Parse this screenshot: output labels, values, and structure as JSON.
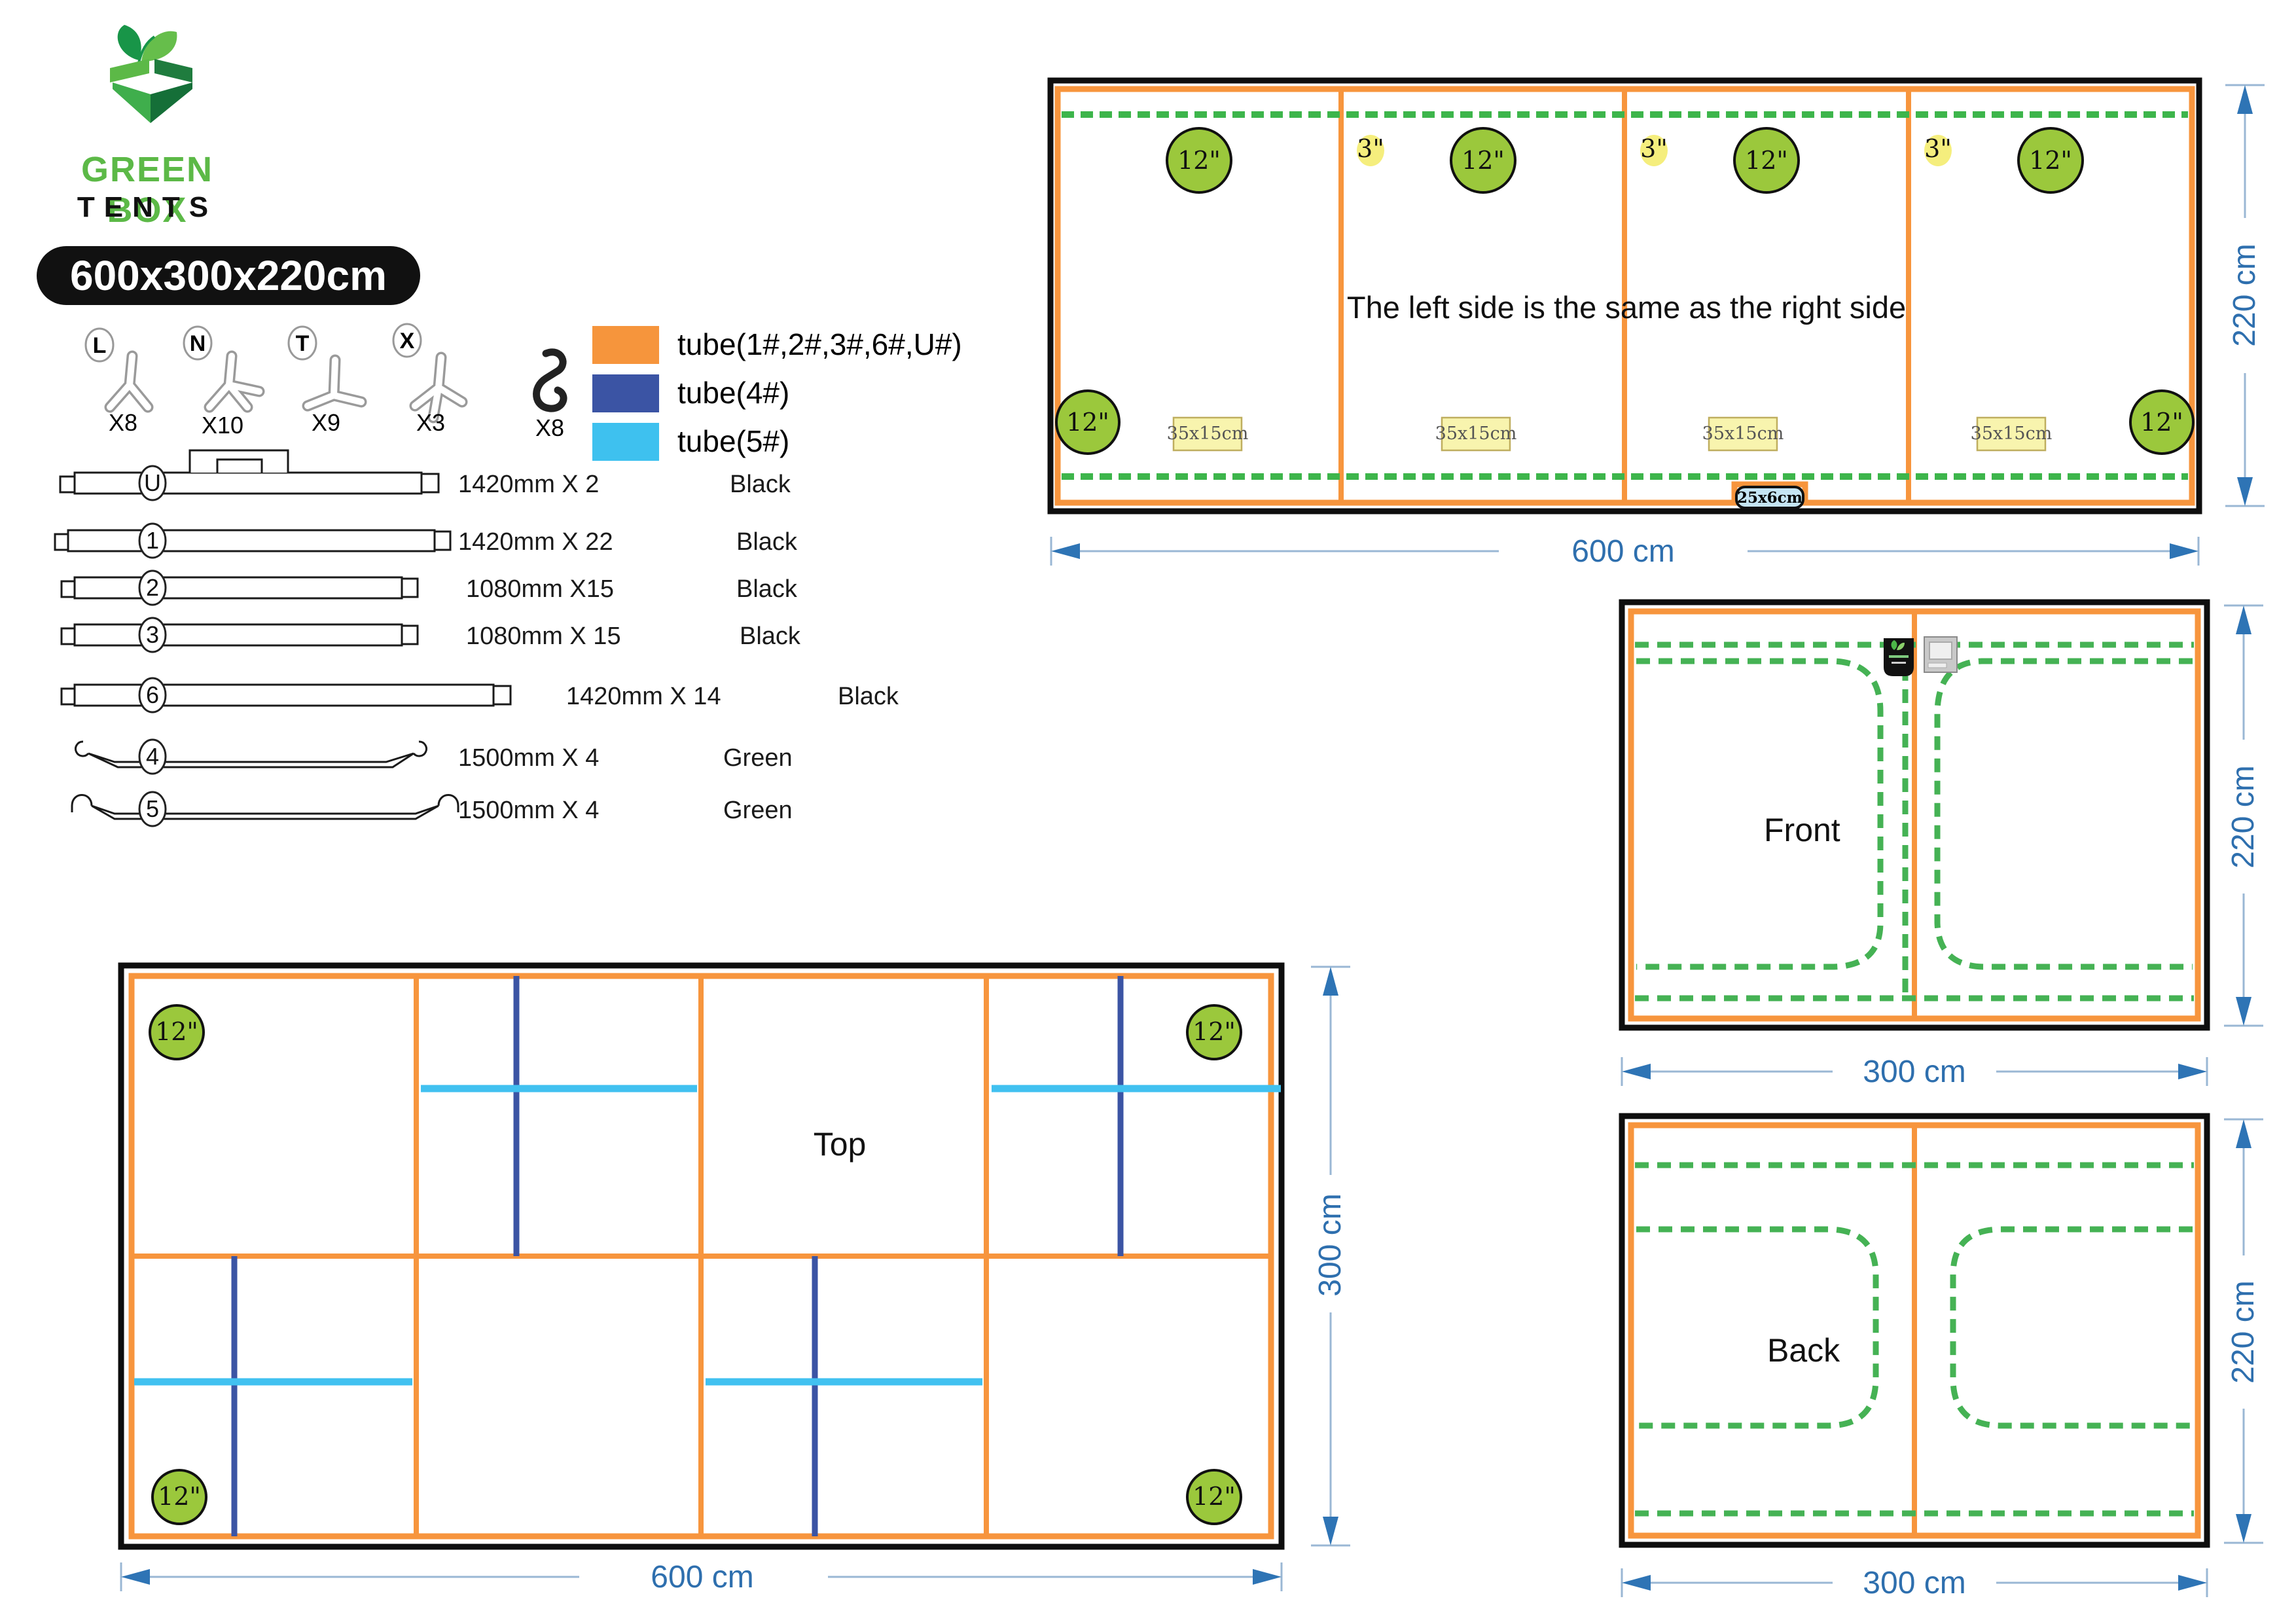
{
  "header": {
    "brand_top": "GREEN BOX",
    "brand_bottom": "TENTS",
    "size_badge": "600x300x220cm"
  },
  "connectors": [
    {
      "id": "L",
      "count": "X8"
    },
    {
      "id": "N",
      "count": "X10"
    },
    {
      "id": "T",
      "count": "X9"
    },
    {
      "id": "X",
      "count": "X3"
    },
    {
      "id": "hook",
      "count": "X8"
    }
  ],
  "legend": [
    {
      "swatch": "#F6953C",
      "label": "tube(1#,2#,3#,6#,U#)"
    },
    {
      "swatch": "#3B54A4",
      "label": "tube(4#)"
    },
    {
      "swatch": "#3EC1EF",
      "label": "tube(5#)"
    }
  ],
  "poles": [
    {
      "id": "U",
      "spec": "1420mm X 2",
      "color": "Black"
    },
    {
      "id": "1",
      "spec": "1420mm X 22",
      "color": "Black"
    },
    {
      "id": "2",
      "spec": "1080mm X15",
      "color": "Black"
    },
    {
      "id": "3",
      "spec": "1080mm X 15",
      "color": "Black"
    },
    {
      "id": "6",
      "spec": "1420mm X 14",
      "color": "Black"
    },
    {
      "id": "4",
      "spec": "1500mm X 4",
      "color": "Green"
    },
    {
      "id": "5",
      "spec": "1500mm X 4",
      "color": "Green"
    }
  ],
  "panels": {
    "side": {
      "note": "The left side is the same as the right side",
      "vent_large": "12\"",
      "vent_small": "3\"",
      "pocket_label": "35x15cm",
      "outlet_label": "25x6cm",
      "width_label": "600 cm",
      "height_label": "220 cm"
    },
    "front": {
      "label": "Front",
      "width_label": "300 cm",
      "height_label": "220 cm"
    },
    "back": {
      "label": "Back",
      "width_label": "300 cm",
      "height_label": "220 cm"
    },
    "top": {
      "label": "Top",
      "vent": "12\"",
      "width_label": "600 cm",
      "height_label": "300 cm"
    }
  },
  "colors": {
    "tube_orange": "#F6953C",
    "tube_blue": "#3B54A4",
    "tube_cyan": "#3EC1EF",
    "dash_green": "#3DB54B",
    "vent_green": "#9BC83C",
    "label_yellow": "#F8F4AE",
    "outlet_blue": "#C5E5F4",
    "dimension_blue": "#2E74B5",
    "brand_green": "#5CB947",
    "badge_black": "#111111"
  }
}
